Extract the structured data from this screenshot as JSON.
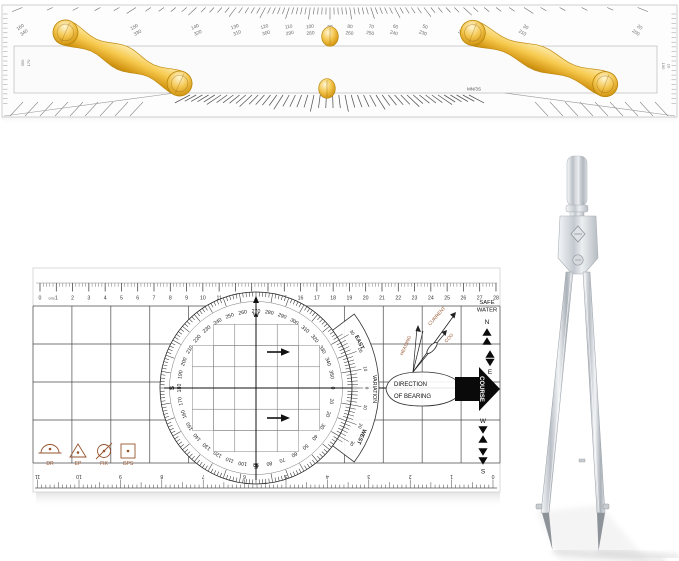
{
  "scene": {
    "background": "#ffffff"
  },
  "colors": {
    "gold": "#F2C14E",
    "gold_deep": "#C9920F",
    "gold_light": "#FDE9A9",
    "ink": "#1f1f1f",
    "scale_ink": "#5f5f5f",
    "grid_line": "#474747",
    "sepia": "#96552F",
    "chrome_mid": "#aab1b8",
    "chrome_light": "#f4f6f7",
    "shadow_grey": "#d9d9d9"
  },
  "parallel_ruler": {
    "top_scale_pairs": [
      [
        "160",
        "340"
      ],
      [
        "150",
        "330"
      ],
      [
        "140",
        "320"
      ],
      [
        "130",
        "310"
      ],
      [
        "120",
        "300"
      ],
      [
        "110",
        "290"
      ],
      [
        "100",
        "280"
      ],
      [
        "90",
        "270"
      ],
      [
        "80",
        "260"
      ],
      [
        "70",
        "250"
      ],
      [
        "60",
        "240"
      ],
      [
        "50",
        "230"
      ],
      [
        "40",
        "220"
      ],
      [
        "30",
        "210"
      ],
      [
        "20",
        "200"
      ]
    ],
    "left_edge_labels": [
      "350",
      "170"
    ],
    "right_edge_labels": [
      "190",
      "10"
    ],
    "bottom_labels": {
      "left": "MS/3N",
      "center": "S",
      "right": "MN/3S"
    }
  },
  "plotter": {
    "cm_scale": {
      "zero_label": "0",
      "unit_label": "cms",
      "max_cm": 28
    },
    "compass_rose": {
      "degree_labels": [
        0,
        10,
        20,
        30,
        40,
        50,
        60,
        70,
        80,
        90,
        100,
        110,
        120,
        130,
        140,
        150,
        160,
        170,
        180,
        190,
        200,
        210,
        220,
        230,
        240,
        250,
        260,
        270,
        280,
        290,
        300,
        310,
        320,
        330,
        340,
        350
      ],
      "axis_letters": {
        "top": "W",
        "left": "S",
        "bottom": "E"
      }
    },
    "variation_arm": {
      "title": "VARIATION",
      "east": "EAST",
      "west": "WEST",
      "numbers": [
        "30",
        "20",
        "10",
        "0",
        "10",
        "20",
        "30"
      ]
    },
    "right_panel": {
      "safe_water_line1": "SAFE",
      "safe_water_line2": "WATER",
      "north": "N",
      "east": "E",
      "west": "W",
      "south": "S",
      "course": "COURSE"
    },
    "vector_labels": {
      "current": "CURRENT",
      "heading": "HEADING",
      "cog": "COG"
    },
    "bearing_ellipse": {
      "line1": "DIRECTION",
      "line2": "OF BEARING"
    },
    "position_symbols": [
      {
        "label": "DR"
      },
      {
        "label": "EP"
      },
      {
        "label": "FIX"
      },
      {
        "label": "GPS"
      }
    ],
    "bottom_scale": {
      "numbers": [
        "0",
        "1",
        "2",
        "3",
        "4",
        "5",
        "6",
        "7",
        "8",
        "9",
        "10",
        "11"
      ],
      "orientation": "inverted"
    }
  }
}
